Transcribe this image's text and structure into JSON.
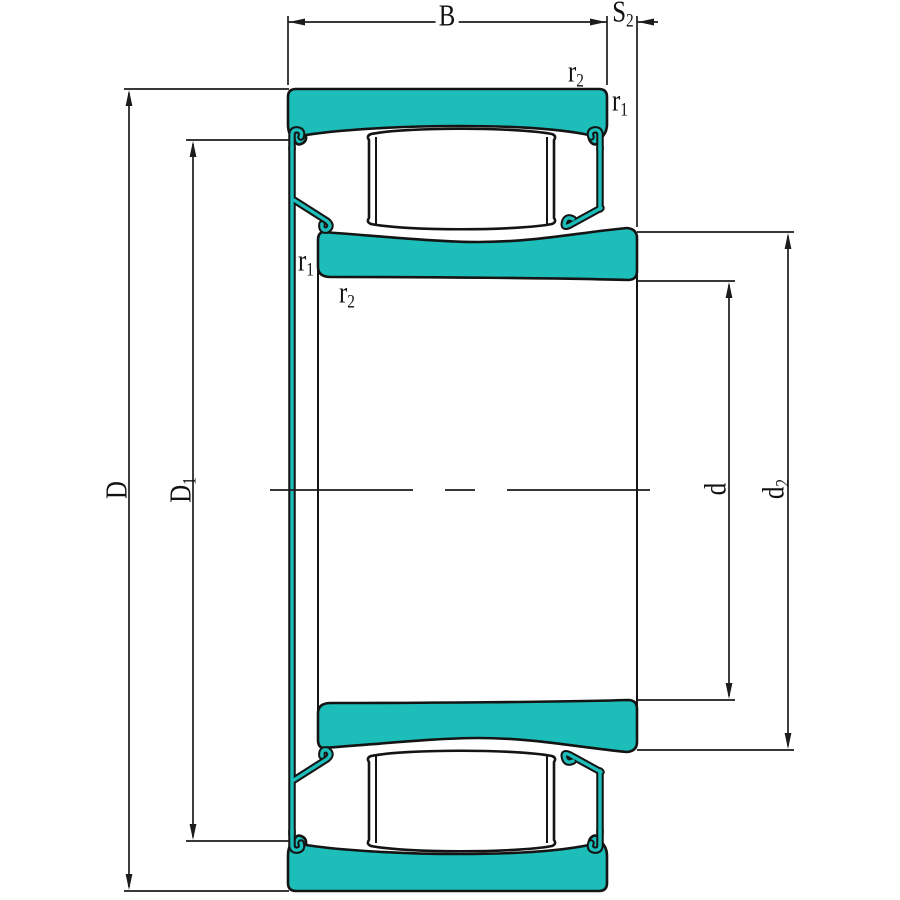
{
  "labels": {
    "b": {
      "base": "B",
      "sub": ""
    },
    "s2": {
      "base": "S",
      "sub": "2"
    },
    "r2_top": {
      "base": "r",
      "sub": "2"
    },
    "r1_top": {
      "base": "r",
      "sub": "1"
    },
    "r1_left": {
      "base": "r",
      "sub": "1"
    },
    "r2_left": {
      "base": "r",
      "sub": "2"
    },
    "D": {
      "base": "D",
      "sub": ""
    },
    "D1": {
      "base": "D",
      "sub": "1"
    },
    "d": {
      "base": "d",
      "sub": ""
    },
    "d2": {
      "base": "d",
      "sub": "2"
    }
  },
  "colors": {
    "ring_fill": "#1dbeb9",
    "outline": "#141414",
    "dimension_line": "#1c1c1c",
    "background": "#ffffff"
  }
}
